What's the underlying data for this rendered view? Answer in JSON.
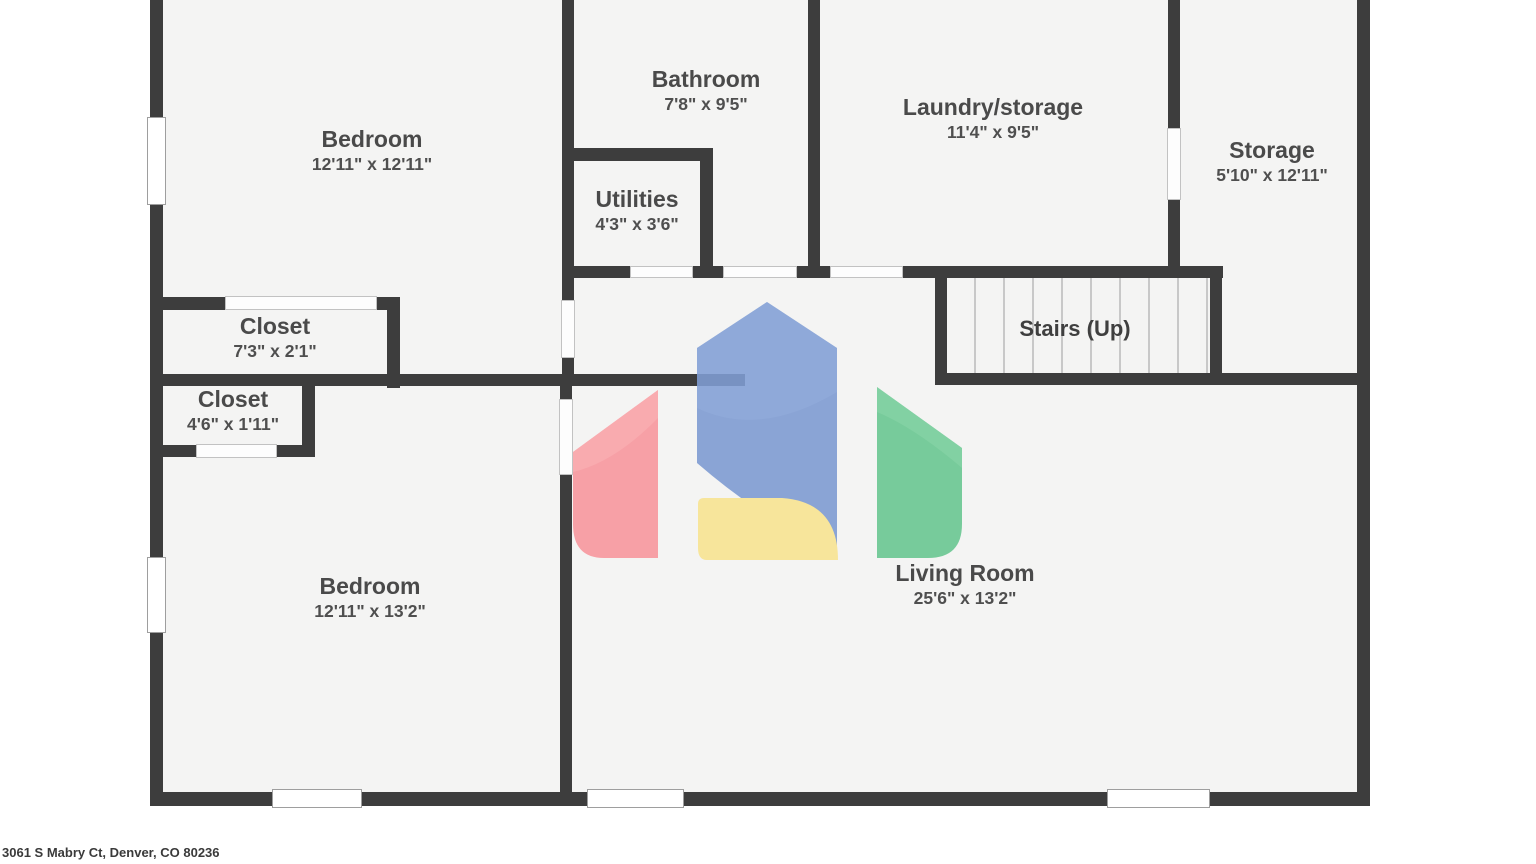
{
  "address": "3061 S Mabry Ct, Denver, CO 80236",
  "rooms": [
    {
      "id": "bedroom-1",
      "name": "Bedroom",
      "dims": "12'11\" x 12'11\""
    },
    {
      "id": "bathroom",
      "name": "Bathroom",
      "dims": "7'8\" x 9'5\""
    },
    {
      "id": "laundry",
      "name": "Laundry/storage",
      "dims": "11'4\" x 9'5\""
    },
    {
      "id": "storage",
      "name": "Storage",
      "dims": "5'10\" x 12'11\""
    },
    {
      "id": "utilities",
      "name": "Utilities",
      "dims": "4'3\" x 3'6\""
    },
    {
      "id": "closet-1",
      "name": "Closet",
      "dims": "7'3\" x 2'1\""
    },
    {
      "id": "closet-2",
      "name": "Closet",
      "dims": "4'6\" x 1'11\""
    },
    {
      "id": "bedroom-2",
      "name": "Bedroom",
      "dims": "12'11\" x 13'2\""
    },
    {
      "id": "living-room",
      "name": "Living Room",
      "dims": "25'6\" x 13'2\""
    }
  ],
  "stairs_label": "Stairs (Up)",
  "colors": {
    "wall": "#3d3d3d",
    "floor": "#f4f4f3",
    "label_text": "#4a4a4a",
    "logo_blue": "#7b99d1",
    "logo_red": "#f8949b",
    "logo_green": "#65c68e",
    "logo_yellow": "#f8e38f"
  }
}
